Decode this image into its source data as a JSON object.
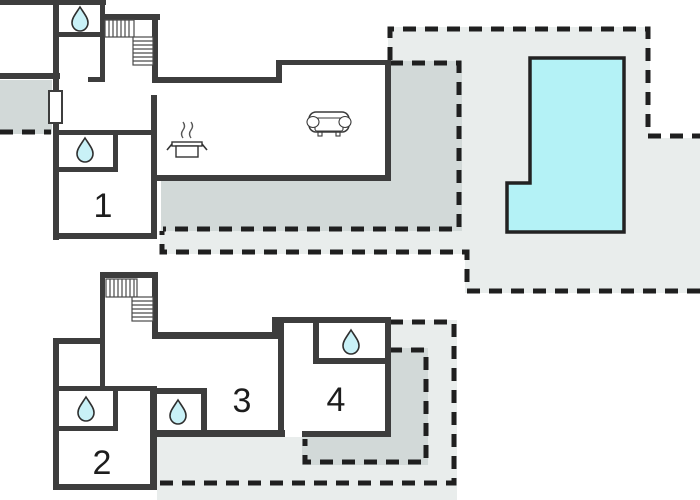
{
  "floor_plan": {
    "rooms": [
      {
        "label": "1"
      },
      {
        "label": "2"
      },
      {
        "label": "3"
      },
      {
        "label": "4"
      }
    ],
    "icons": [
      "water-drop-icon",
      "stairs-icon",
      "sofa-icon",
      "cooking-pot-icon"
    ],
    "features": [
      "swimming-pool",
      "terrace-light",
      "terrace-dark",
      "window",
      "dashed-boundary"
    ],
    "colors": {
      "wall": "#3d3d3d",
      "pool_water": "#b4f2f6",
      "drop_water": "#c9f1f7",
      "terrace_light": "#e9edec",
      "terrace_dark": "#d2d9d8",
      "dashed_line": "#1f1f1f",
      "background": "#ffffff"
    }
  }
}
